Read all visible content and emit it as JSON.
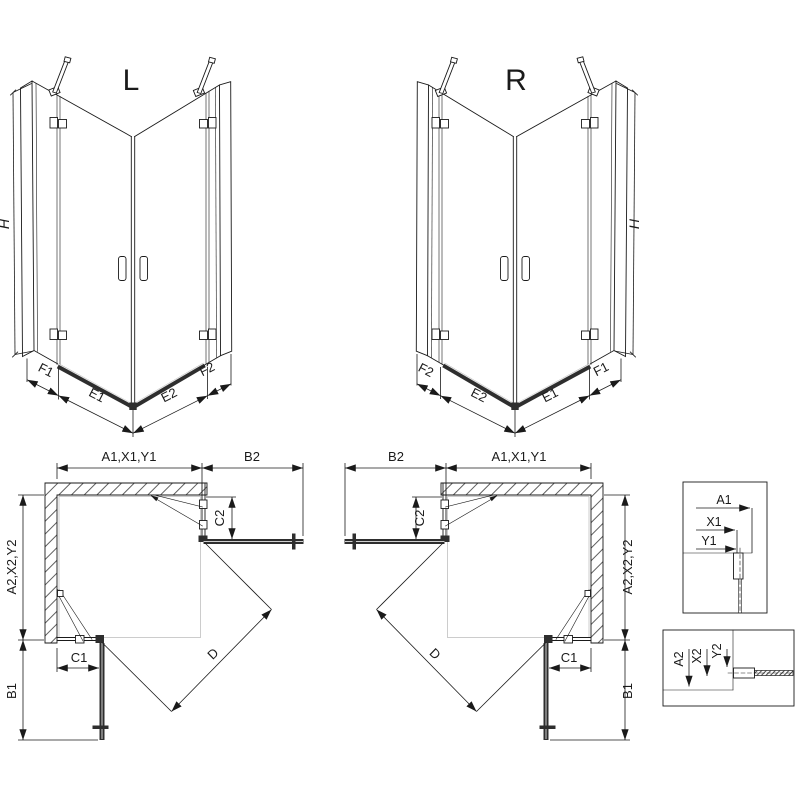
{
  "colors": {
    "line": "#1a1a1a",
    "bar": "#2e2e2e",
    "background": "#ffffff"
  },
  "iso_l": {
    "title": "L",
    "h": "H",
    "f1": "F1",
    "e1": "E1",
    "e2": "E2",
    "f2": "F2"
  },
  "iso_r": {
    "title": "R",
    "h": "H",
    "f1": "F1",
    "e1": "E1",
    "e2": "E2",
    "f2": "F2"
  },
  "plan_l": {
    "width_dim": "A1,X1,Y1",
    "door_dim": "B2",
    "depth_dim": "A2,X2,Y2",
    "c2": "C2",
    "c1": "C1",
    "b1": "B1",
    "d": "D"
  },
  "plan_r": {
    "width_dim": "A1,X1,Y1",
    "door_dim": "B2",
    "depth_dim": "A2,X2,Y2",
    "c2": "C2",
    "c1": "C1",
    "b1": "B1",
    "d": "D"
  },
  "detail_top": {
    "a1": "A1",
    "x1": "X1",
    "y1": "Y1"
  },
  "detail_bottom": {
    "a2": "A2",
    "x2": "X2",
    "y2": "Y2"
  }
}
